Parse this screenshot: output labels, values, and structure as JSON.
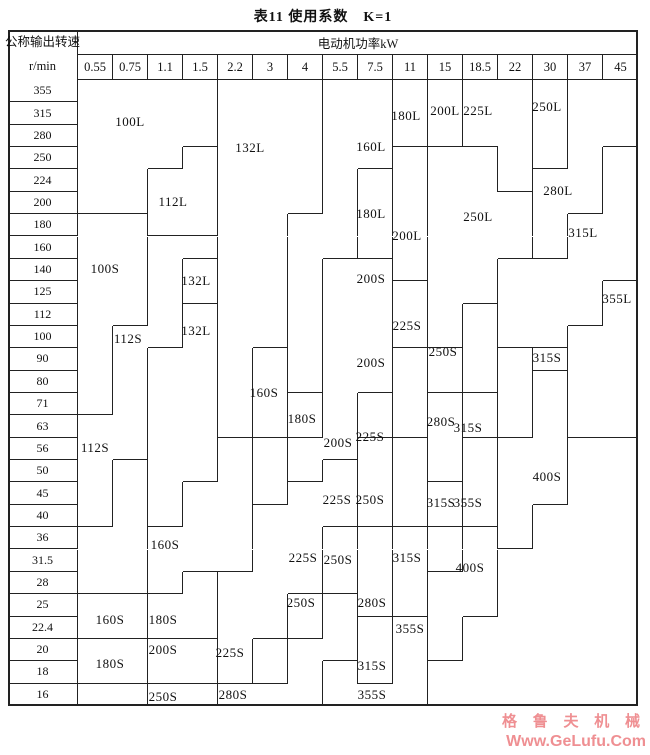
{
  "title": "表11 使用系数　K=1",
  "watermark": {
    "line1": "格 鲁 夫 机 械",
    "line2": "Www.GeLufu.Com",
    "color": "#ef8f92"
  },
  "table": {
    "corner_top": "公称输出转速",
    "corner_bottom": "r/min",
    "power_header": "电动机功率kW",
    "powers": [
      "0.55",
      "0.75",
      "1.1",
      "1.5",
      "2.2",
      "3",
      "4",
      "5.5",
      "7.5",
      "11",
      "15",
      "18.5",
      "22",
      "30",
      "37",
      "45"
    ],
    "speeds": [
      "355",
      "315",
      "280",
      "250",
      "224",
      "200",
      "180",
      "160",
      "140",
      "125",
      "112",
      "100",
      "90",
      "80",
      "71",
      "63",
      "56",
      "50",
      "45",
      "40",
      "36",
      "31.5",
      "28",
      "25",
      "22.4",
      "20",
      "18",
      "16"
    ],
    "geometry": {
      "left": 8,
      "top": 30,
      "body_left": 78,
      "body_top": 80,
      "col_width": 35,
      "right": 638,
      "bottom": 706,
      "header_mid": 55
    },
    "columns": [
      [
        {
          "id": "100L",
          "f": 0,
          "t": 5
        },
        {
          "id": "100S",
          "f": 6,
          "t": 14
        },
        {
          "id": "112S",
          "f": 15,
          "t": 19
        },
        {
          "id": "BL1",
          "f": 20,
          "t": 22
        },
        {
          "id": "160Sb",
          "f": 23,
          "t": 24
        },
        {
          "id": "180Sb",
          "f": 25,
          "t": 26
        },
        {
          "id": "BL2",
          "f": 27,
          "t": 27
        }
      ],
      [
        {
          "id": "100L",
          "f": 0,
          "t": 5
        },
        {
          "id": "100S",
          "f": 6,
          "t": 10
        },
        {
          "id": "112S",
          "f": 11,
          "t": 16
        },
        {
          "id": "BL1",
          "f": 17,
          "t": 22
        },
        {
          "id": "160Sb",
          "f": 23,
          "t": 24
        },
        {
          "id": "180Sb",
          "f": 25,
          "t": 26
        },
        {
          "id": "BL2",
          "f": 27,
          "t": 27
        }
      ],
      [
        {
          "id": "100L",
          "f": 0,
          "t": 3
        },
        {
          "id": "112L",
          "f": 4,
          "t": 6
        },
        {
          "id": "112S",
          "f": 7,
          "t": 11
        },
        {
          "id": "132Llow",
          "f": 12,
          "t": 19
        },
        {
          "id": "160Sbig",
          "f": 20,
          "t": 22
        },
        {
          "id": "180Sbl",
          "f": 23,
          "t": 24
        },
        {
          "id": "200Sbl",
          "f": 25,
          "t": 26
        },
        {
          "id": "250Sbot",
          "f": 27,
          "t": 27
        }
      ],
      [
        {
          "id": "100L",
          "f": 0,
          "t": 2
        },
        {
          "id": "112L",
          "f": 3,
          "t": 6
        },
        {
          "id": "112S",
          "f": 7,
          "t": 7
        },
        {
          "id": "132Lbox",
          "f": 8,
          "t": 9
        },
        {
          "id": "132Llow",
          "f": 10,
          "t": 17
        },
        {
          "id": "160Sbig",
          "f": 18,
          "t": 21
        },
        {
          "id": "180Sbl",
          "f": 22,
          "t": 24
        },
        {
          "id": "200Sbl",
          "f": 25,
          "t": 26
        },
        {
          "id": "250Sbot",
          "f": 27,
          "t": 27
        }
      ],
      [
        {
          "id": "132Lbig",
          "f": 0,
          "t": 15
        },
        {
          "id": "160Sbig",
          "f": 16,
          "t": 21
        },
        {
          "id": "225Sl",
          "f": 22,
          "t": 26
        },
        {
          "id": "280Sb",
          "f": 27,
          "t": 27
        }
      ],
      [
        {
          "id": "132Lbig",
          "f": 0,
          "t": 11
        },
        {
          "id": "160Sbig",
          "f": 12,
          "t": 15
        },
        {
          "id": "180Sm",
          "f": 16,
          "t": 18
        },
        {
          "id": "225Sl",
          "f": 19,
          "t": 24
        },
        {
          "id": "250Sc5",
          "f": 25,
          "t": 26
        },
        {
          "id": "280Sb",
          "f": 27,
          "t": 27
        }
      ],
      [
        {
          "id": "132Lbig",
          "f": 0,
          "t": 5
        },
        {
          "id": "160L",
          "f": 6,
          "t": 13
        },
        {
          "id": "180Sm",
          "f": 14,
          "t": 15
        },
        {
          "id": "200Sbig",
          "f": 16,
          "t": 17
        },
        {
          "id": "225Sl",
          "f": 18,
          "t": 22
        },
        {
          "id": "250Sc6",
          "f": 23,
          "t": 24
        },
        {
          "id": "280Sb",
          "f": 25,
          "t": 27
        }
      ],
      [
        {
          "id": "160L",
          "f": 0,
          "t": 7
        },
        {
          "id": "200Sbig",
          "f": 8,
          "t": 16
        },
        {
          "id": "225Sl",
          "f": 17,
          "t": 19
        },
        {
          "id": "250Sc7",
          "f": 20,
          "t": 22
        },
        {
          "id": "280Sb",
          "f": 23,
          "t": 25
        },
        {
          "id": "355Sb",
          "f": 26,
          "t": 27
        }
      ],
      [
        {
          "id": "160L",
          "f": 0,
          "t": 3
        },
        {
          "id": "180Lm",
          "f": 4,
          "t": 7
        },
        {
          "id": "200Sbig",
          "f": 8,
          "t": 13
        },
        {
          "id": "225Sc8",
          "f": 14,
          "t": 15
        },
        {
          "id": "250Sc8",
          "f": 16,
          "t": 19
        },
        {
          "id": "280Sc8",
          "f": 20,
          "t": 23
        },
        {
          "id": "315Sc8",
          "f": 24,
          "t": 26
        },
        {
          "id": "355Sb",
          "f": 27,
          "t": 27
        }
      ],
      [
        {
          "id": "180Lt",
          "f": 0,
          "t": 2
        },
        {
          "id": "200Lm",
          "f": 3,
          "t": 8
        },
        {
          "id": "225Sc9",
          "f": 9,
          "t": 11
        },
        {
          "id": "250Sc9",
          "f": 12,
          "t": 15
        },
        {
          "id": "280Sc9",
          "f": 16,
          "t": 19
        },
        {
          "id": "315Sc9",
          "f": 20,
          "t": 23
        },
        {
          "id": "355Sb",
          "f": 24,
          "t": 27
        }
      ],
      [
        {
          "id": "200Lt",
          "f": 0,
          "t": 2
        },
        {
          "id": "250Lm",
          "f": 3,
          "t": 11
        },
        {
          "id": "250Sc10",
          "f": 12,
          "t": 13
        },
        {
          "id": "280Sc10",
          "f": 14,
          "t": 17
        },
        {
          "id": "315Sc10",
          "f": 18,
          "t": 19
        },
        {
          "id": "355Sc10",
          "f": 20,
          "t": 21
        },
        {
          "id": "400S2",
          "f": 22,
          "t": 25
        },
        {
          "id": "BR",
          "f": 26,
          "t": 27
        }
      ],
      [
        {
          "id": "225L",
          "f": 0,
          "t": 2
        },
        {
          "id": "250Lm",
          "f": 3,
          "t": 9
        },
        {
          "id": "280Sc11",
          "f": 10,
          "t": 13
        },
        {
          "id": "315Sc11",
          "f": 14,
          "t": 15
        },
        {
          "id": "355Sc11",
          "f": 16,
          "t": 19
        },
        {
          "id": "400S2",
          "f": 20,
          "t": 23
        },
        {
          "id": "BR",
          "f": 24,
          "t": 27
        }
      ],
      [
        {
          "id": "225L",
          "f": 0,
          "t": 4
        },
        {
          "id": "250Lm",
          "f": 5,
          "t": 7
        },
        {
          "id": "315L",
          "f": 8,
          "t": 11
        },
        {
          "id": "355Sc12",
          "f": 12,
          "t": 15
        },
        {
          "id": "400Sbig",
          "f": 16,
          "t": 20
        },
        {
          "id": "BR",
          "f": 21,
          "t": 27
        }
      ],
      [
        {
          "id": "250Lt",
          "f": 0,
          "t": 3
        },
        {
          "id": "280L",
          "f": 4,
          "t": 7
        },
        {
          "id": "315L",
          "f": 8,
          "t": 11
        },
        {
          "id": "315Sbox",
          "f": 12,
          "t": 12
        },
        {
          "id": "400Sbig",
          "f": 13,
          "t": 18
        },
        {
          "id": "BR",
          "f": 19,
          "t": 27
        }
      ],
      [
        {
          "id": "280L",
          "f": 0,
          "t": 5
        },
        {
          "id": "315L",
          "f": 6,
          "t": 10
        },
        {
          "id": "355L",
          "f": 11,
          "t": 15
        },
        {
          "id": "BR",
          "f": 16,
          "t": 27
        }
      ],
      [
        {
          "id": "280L",
          "f": 0,
          "t": 2
        },
        {
          "id": "315L",
          "f": 3,
          "t": 8
        },
        {
          "id": "355L",
          "f": 9,
          "t": 15
        },
        {
          "id": "BR",
          "f": 16,
          "t": 27
        }
      ]
    ],
    "region_labels": [
      {
        "text": "100L",
        "x": 130,
        "y": 122
      },
      {
        "text": "132L",
        "x": 250,
        "y": 148
      },
      {
        "text": "160L",
        "x": 371,
        "y": 147
      },
      {
        "text": "180L",
        "x": 406,
        "y": 116
      },
      {
        "text": "200L",
        "x": 445,
        "y": 111
      },
      {
        "text": "225L",
        "x": 478,
        "y": 111
      },
      {
        "text": "250L",
        "x": 547,
        "y": 107
      },
      {
        "text": "112L",
        "x": 173,
        "y": 202
      },
      {
        "text": "280L",
        "x": 558,
        "y": 191
      },
      {
        "text": "180L",
        "x": 371,
        "y": 214
      },
      {
        "text": "250L",
        "x": 478,
        "y": 217
      },
      {
        "text": "315L",
        "x": 583,
        "y": 233
      },
      {
        "text": "200L",
        "x": 407,
        "y": 236
      },
      {
        "text": "100S",
        "x": 105,
        "y": 269
      },
      {
        "text": "200S",
        "x": 371,
        "y": 279
      },
      {
        "text": "132L",
        "x": 196,
        "y": 281
      },
      {
        "text": "355L",
        "x": 617,
        "y": 299
      },
      {
        "text": "225S",
        "x": 407,
        "y": 326
      },
      {
        "text": "132L",
        "x": 196,
        "y": 331
      },
      {
        "text": "112S",
        "x": 128,
        "y": 339
      },
      {
        "text": "250S",
        "x": 443,
        "y": 352
      },
      {
        "text": "315S",
        "x": 547,
        "y": 358
      },
      {
        "text": "200S",
        "x": 371,
        "y": 363
      },
      {
        "text": "160S",
        "x": 264,
        "y": 393
      },
      {
        "text": "180S",
        "x": 302,
        "y": 419
      },
      {
        "text": "280S",
        "x": 441,
        "y": 422
      },
      {
        "text": "315S",
        "x": 468,
        "y": 428
      },
      {
        "text": "225S",
        "x": 370,
        "y": 437
      },
      {
        "text": "200S",
        "x": 338,
        "y": 443
      },
      {
        "text": "112S",
        "x": 95,
        "y": 448
      },
      {
        "text": "400S",
        "x": 547,
        "y": 477
      },
      {
        "text": "225S",
        "x": 337,
        "y": 500
      },
      {
        "text": "250S",
        "x": 370,
        "y": 500
      },
      {
        "text": "315S",
        "x": 441,
        "y": 503
      },
      {
        "text": "355S",
        "x": 468,
        "y": 503
      },
      {
        "text": "160S",
        "x": 165,
        "y": 545
      },
      {
        "text": "225S",
        "x": 303,
        "y": 558
      },
      {
        "text": "250S",
        "x": 338,
        "y": 560
      },
      {
        "text": "315S",
        "x": 407,
        "y": 558
      },
      {
        "text": "400S",
        "x": 470,
        "y": 568
      },
      {
        "text": "250S",
        "x": 301,
        "y": 603
      },
      {
        "text": "280S",
        "x": 372,
        "y": 603
      },
      {
        "text": "160S",
        "x": 110,
        "y": 620
      },
      {
        "text": "180S",
        "x": 163,
        "y": 620
      },
      {
        "text": "355S",
        "x": 410,
        "y": 629
      },
      {
        "text": "200S",
        "x": 163,
        "y": 650
      },
      {
        "text": "225S",
        "x": 230,
        "y": 653
      },
      {
        "text": "180S",
        "x": 110,
        "y": 664
      },
      {
        "text": "315S",
        "x": 372,
        "y": 666
      },
      {
        "text": "250S",
        "x": 163,
        "y": 697
      },
      {
        "text": "280S",
        "x": 233,
        "y": 695
      },
      {
        "text": "355S",
        "x": 372,
        "y": 695
      }
    ]
  }
}
